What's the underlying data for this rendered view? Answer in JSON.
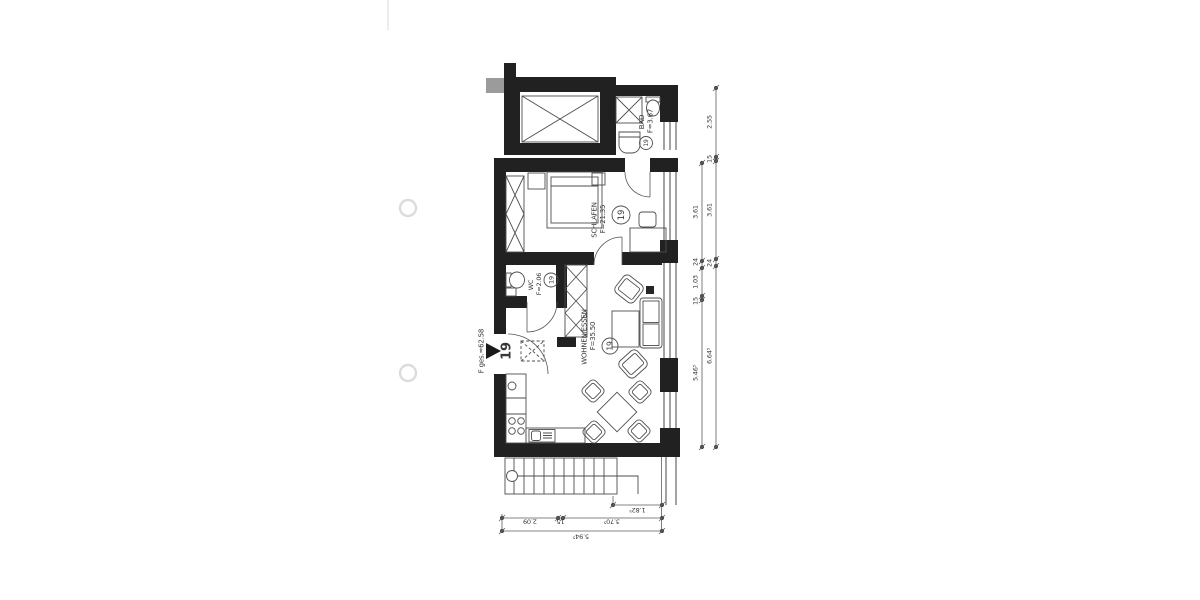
{
  "document": {
    "type": "scanned architectural floor plan",
    "background": "#ffffff"
  },
  "apartment": {
    "number": "19",
    "total_area_label": "F ges.=62.58"
  },
  "rooms": {
    "bad": {
      "name": "BAD",
      "area": "F=3.67"
    },
    "schlafen": {
      "name": "SCHLAFEN",
      "area": "F=21.35"
    },
    "wc": {
      "name": "WC",
      "area": "F=2.06"
    },
    "wohnen": {
      "name": "WOHNEN/ESSEN",
      "area": "F=35.50"
    }
  },
  "dimensions": {
    "right_inner_chain": [
      "3.61",
      "24",
      "1.03",
      "15",
      "5.46⁵"
    ],
    "right_outer_chain": [
      "2.55",
      "15",
      "3.61",
      "24",
      "6.64⁵"
    ],
    "bottom_upper": "1.82⁵",
    "bottom_middle": [
      "2.09",
      "15",
      "3.70⁵"
    ],
    "bottom_lower": "5.94⁵"
  },
  "colors": {
    "wall": "#212121",
    "line": "#474747",
    "text": "#383838",
    "chimney": "#9b9b9b"
  }
}
